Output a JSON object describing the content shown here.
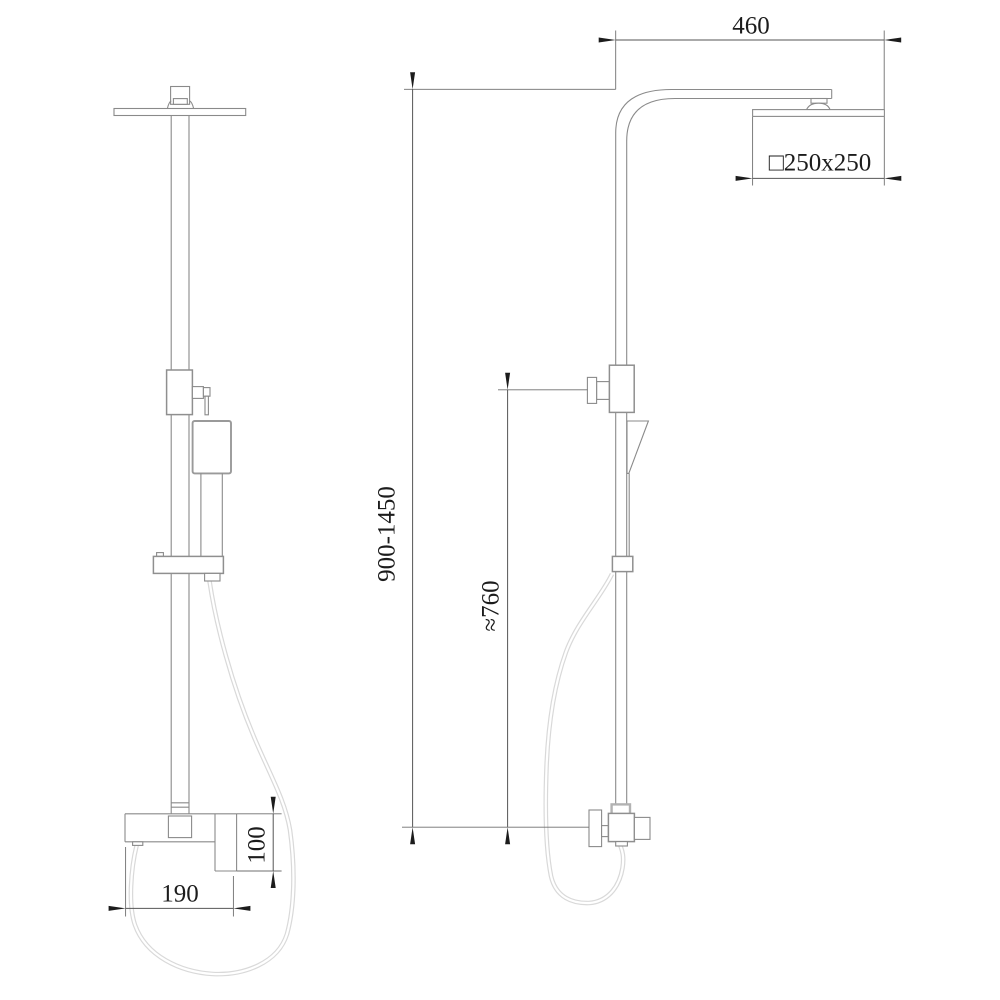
{
  "drawing": {
    "kind": "shower-column-technical-drawing",
    "dimensions": {
      "arm_width": "460",
      "head_plate_size": "□250x250",
      "column_height_range": "900-1450",
      "handshower_height": "≈760",
      "mixer_height": "100",
      "mixer_width": "190"
    },
    "colors": {
      "background": "#ffffff",
      "outline": "#8a8a8a",
      "dimension_line": "#565656",
      "text": "#1c1c1c",
      "hose": "#d9d9d9"
    }
  }
}
